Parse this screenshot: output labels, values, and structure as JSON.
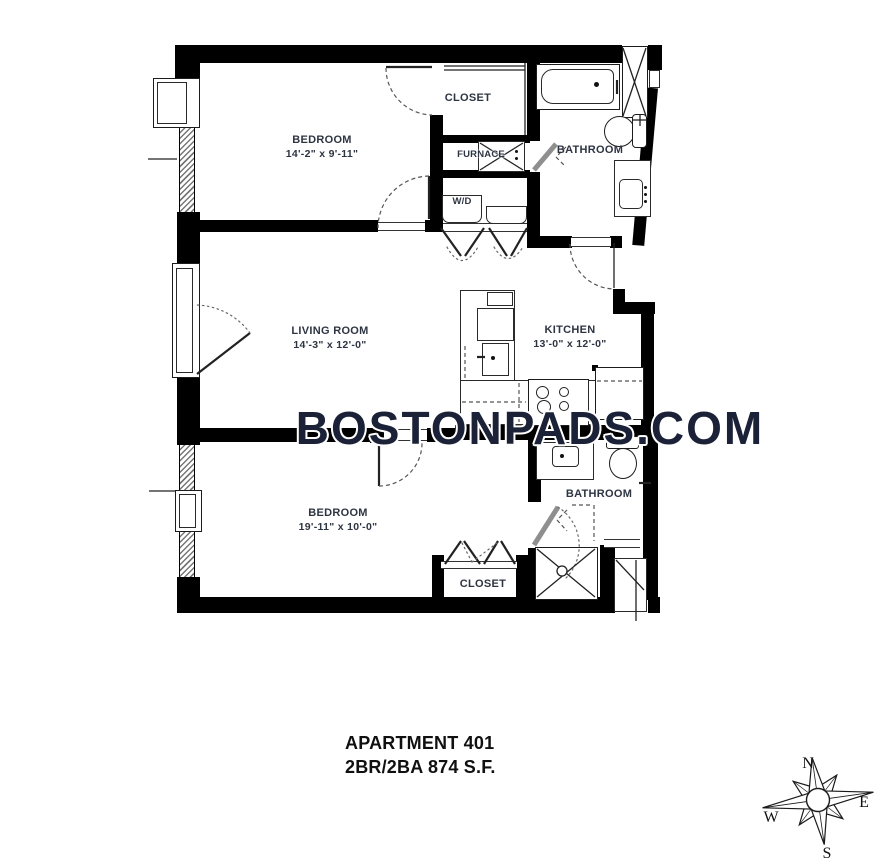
{
  "watermark": "BOSTONPADS.COM",
  "title": {
    "line1": "APARTMENT 401",
    "line2": "2BR/2BA 874 S.F."
  },
  "rooms": {
    "bedroom1": {
      "name": "BEDROOM",
      "dims": "14'-2\" x 9'-11\""
    },
    "closet1": {
      "name": "CLOSET"
    },
    "furnace": {
      "name": "FURNACE"
    },
    "washer_dryer": {
      "name": "W/D"
    },
    "bathroom1": {
      "name": "BATHROOM"
    },
    "living_room": {
      "name": "LIVING ROOM",
      "dims": "14'-3\" x 12'-0\""
    },
    "kitchen": {
      "name": "KITCHEN",
      "dims": "13'-0\" x 12'-0\""
    },
    "bedroom2": {
      "name": "BEDROOM",
      "dims": "19'-11\" x 10'-0\""
    },
    "bathroom2": {
      "name": "BATHROOM"
    },
    "closet2": {
      "name": "CLOSET"
    }
  },
  "compass": {
    "north": "N",
    "east": "E",
    "south": "S",
    "west": "W"
  },
  "colors": {
    "wall": "#000000",
    "label": "#2d3442",
    "watermark": "#1b2238",
    "door": "#8f8f8f"
  }
}
